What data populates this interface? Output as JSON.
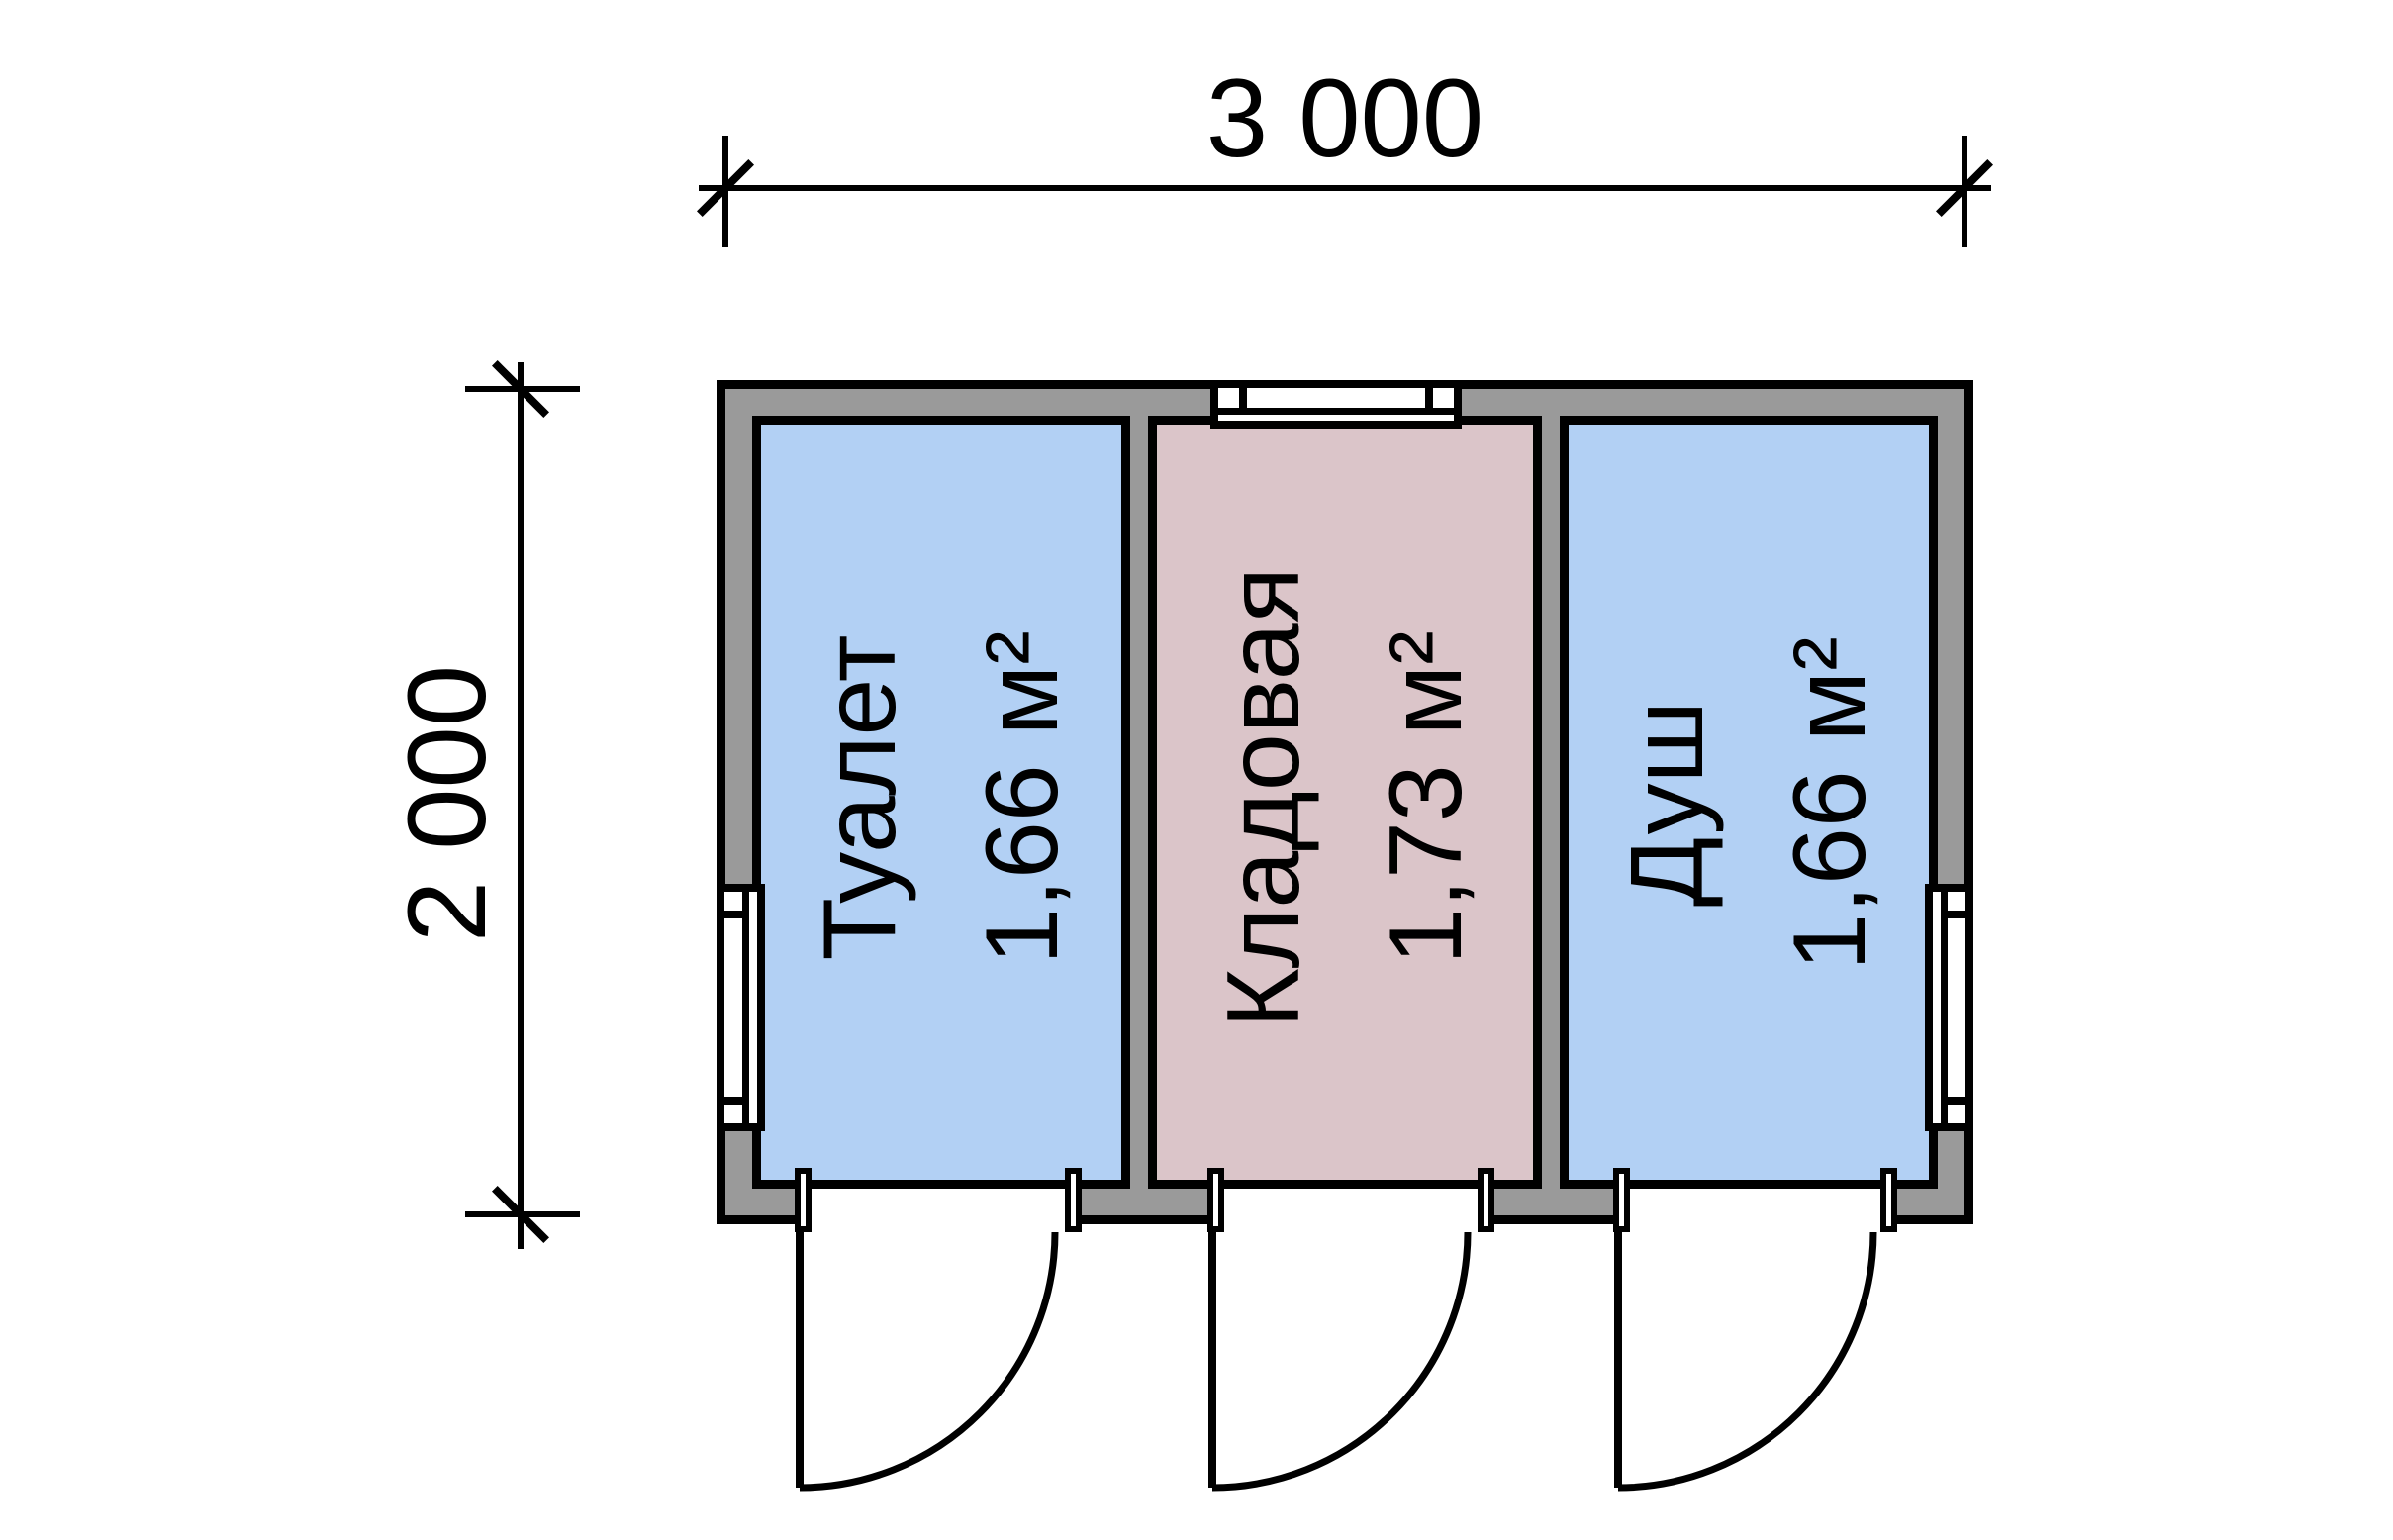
{
  "plan": {
    "dimension_width": {
      "label": "3 000"
    },
    "dimension_height": {
      "label": "2 000"
    },
    "rooms": [
      {
        "name": "Туалет",
        "area": "1,66 м²",
        "fill": "#B2D0F4"
      },
      {
        "name": "Кладовая",
        "area": "1,73 м²",
        "fill": "#DBC5C9"
      },
      {
        "name": "Душ",
        "area": "1,66 м²",
        "fill": "#B2D0F4"
      }
    ],
    "colors": {
      "wall": "#9A9A9A",
      "line": "#000000",
      "background": "#FFFFFF",
      "window_glass": "#FFFFFF"
    }
  }
}
